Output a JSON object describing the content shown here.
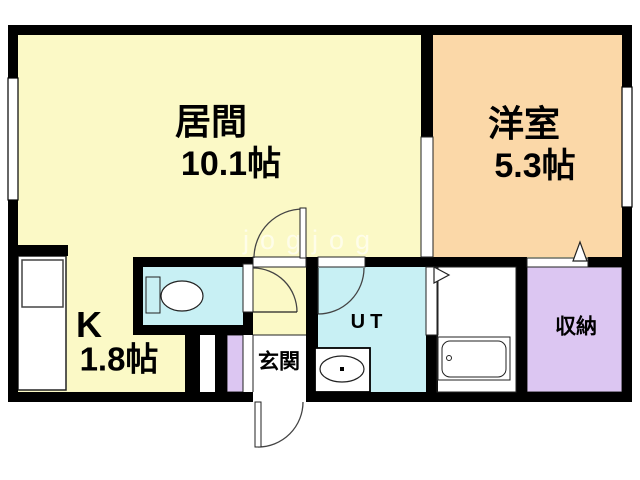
{
  "floorplan": {
    "title": "1K apartment floor plan",
    "rooms": {
      "living": {
        "name": "居間",
        "area": "10.1帖"
      },
      "western": {
        "name": "洋室",
        "area": "5.3帖"
      },
      "kitchen": {
        "name": "K",
        "area": "1.8帖"
      },
      "utility": {
        "name": "UT"
      },
      "entrance": {
        "name": "玄関"
      },
      "closet": {
        "name": "収納"
      }
    },
    "fixtures": [
      "toilet-icon",
      "bathtub-icon",
      "wash-basin-icon",
      "kitchen-counter-icon"
    ],
    "watermark": "jogjog",
    "colors": {
      "room-yellow": "#FBF9C6",
      "room-orange": "#FBD8A8",
      "room-cyan": "#C8F0F4",
      "room-lavender": "#DCC6F2",
      "wall": "#000000",
      "floor-white": "#FFFFFF",
      "outline": "#222222",
      "watermark-color": "rgba(255,255,255,0.6)"
    }
  }
}
